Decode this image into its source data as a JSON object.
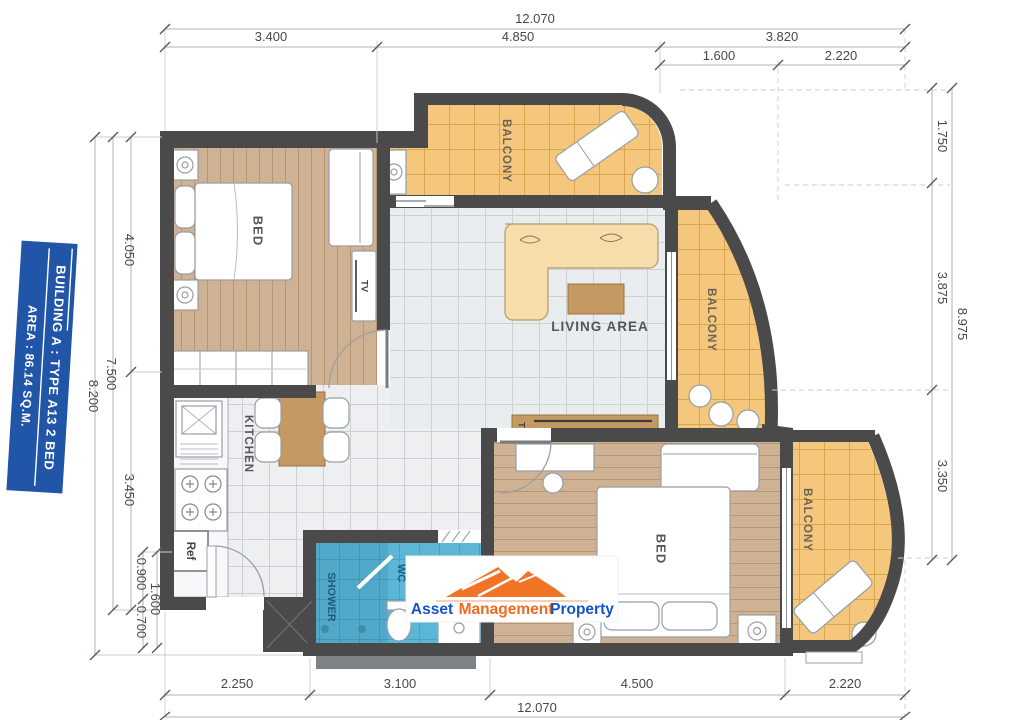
{
  "plan": {
    "badge": {
      "line1": "BUILDING A : TYPE A13 2 BED",
      "line2": "AREA : 86.14 SQ.M."
    },
    "rooms": {
      "bedroom1": "BED",
      "bedroom2": "BED",
      "living": "LIVING AREA",
      "kitchen": "KITCHEN",
      "shower": "SHOWER",
      "wc": "WC",
      "balcony1": "BALCONY",
      "balcony2": "BALCONY",
      "balcony3": "BALCONY",
      "fridge": "Ref",
      "tv_bedroom": "TV",
      "tv_living": "TV"
    },
    "dims": {
      "top": [
        "12.070",
        "3.400",
        "4.850",
        "3.820",
        "1.600",
        "2.220"
      ],
      "bottom": [
        "2.250",
        "3.100",
        "4.500",
        "2.220",
        "12.070"
      ],
      "left": [
        "4.050",
        "7.500",
        "8.200",
        "3.450",
        "0.900",
        "1.600",
        "0.700"
      ],
      "right": [
        "1.750",
        "3.875",
        "8.975",
        "3.350"
      ]
    },
    "logo": {
      "word1": "Asset",
      "word2": "Management",
      "word3": "Property"
    },
    "colors": {
      "accent_blue": "#2155a8",
      "logo_orange": "#ef6a1e",
      "logo_blue": "#1553c8",
      "balcony": "#f4c77c",
      "wood_floor": "#cfb293",
      "bath": "#5cb6d6",
      "wall": "#4a4a4a"
    }
  }
}
